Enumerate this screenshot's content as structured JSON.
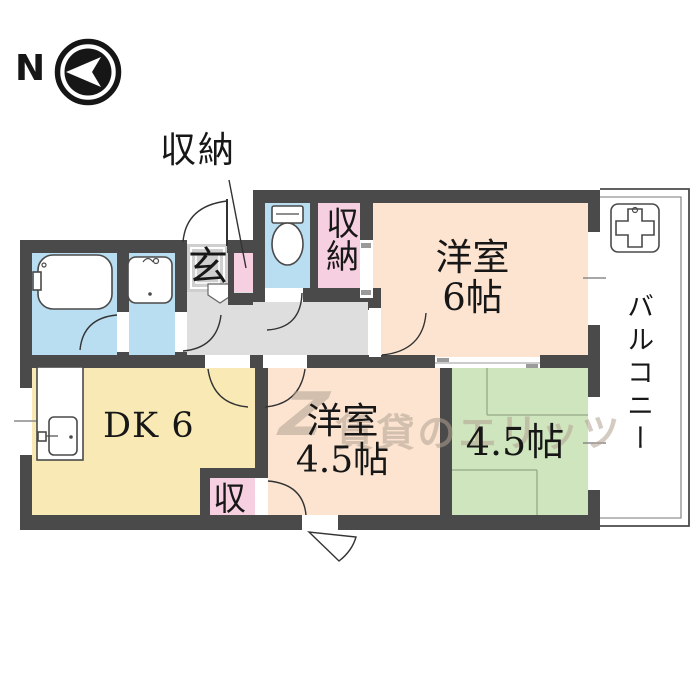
{
  "compass": {
    "label": "N"
  },
  "callout": {
    "closet_label": "収納"
  },
  "rooms": {
    "entrance": "玄",
    "upper_closet": "収納",
    "western_room_6": "洋室\n6帖",
    "balcony": "バルコニー",
    "dining_kitchen": "DK 6",
    "western_room_45": "洋室\n4.5帖",
    "tatami_room_45": "4.5帖",
    "lower_closet": "収"
  },
  "watermark": {
    "logo_mark": "Z",
    "text": "賃貸のエリッツ"
  },
  "colors": {
    "wall": "#4a4a4a",
    "western_room": "#fce4d1",
    "dining_kitchen": "#f8e9b5",
    "tatami_room": "#cfe5bd",
    "closet": "#f6cfe0",
    "wet_area": "#b9ddf1",
    "hallway": "#dedede",
    "entrance_tile": "#cfcfcf"
  }
}
